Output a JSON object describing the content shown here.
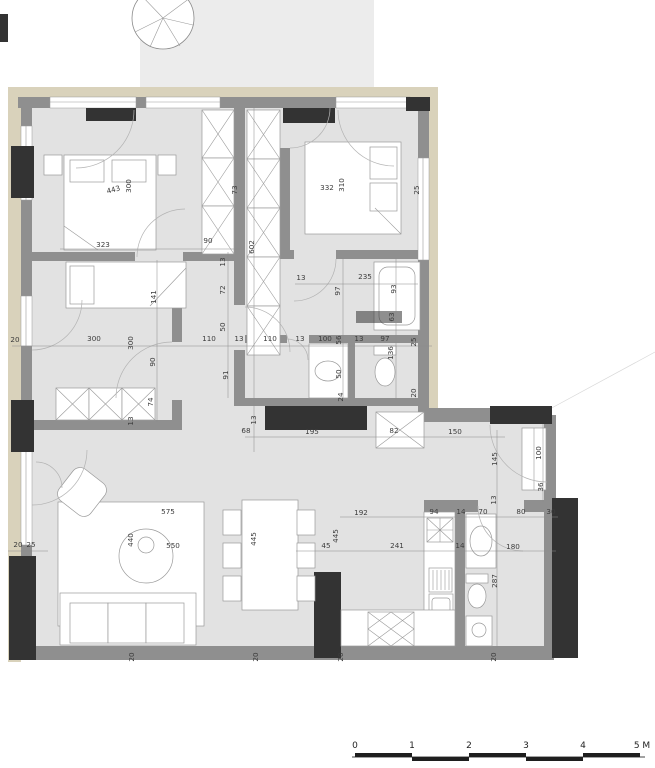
{
  "colors": {
    "paper": "#ffffff",
    "floor": "#e2e2e2",
    "terrace": "#ececec",
    "facade": "#d9d2bb",
    "wall": "#8f8f8f",
    "dark": "#333333"
  },
  "scale_bar": {
    "ticks": [
      {
        "label": "0",
        "x": 355
      },
      {
        "label": "1",
        "x": 412
      },
      {
        "label": "2",
        "x": 469
      },
      {
        "label": "3",
        "x": 526
      },
      {
        "label": "4",
        "x": 583
      },
      {
        "label": "5 M",
        "x": 642
      }
    ]
  },
  "plan_labels": [
    {
      "text": "443",
      "x": 114,
      "y": 192,
      "rot": -15
    },
    {
      "text": "300",
      "x": 131,
      "y": 186,
      "rot": -90
    },
    {
      "text": "323",
      "x": 103,
      "y": 247,
      "rot": 0
    },
    {
      "text": "90",
      "x": 208,
      "y": 243,
      "rot": 0
    },
    {
      "text": "73",
      "x": 237,
      "y": 190,
      "rot": -90
    },
    {
      "text": "13",
      "x": 225,
      "y": 262,
      "rot": -90
    },
    {
      "text": "602",
      "x": 254,
      "y": 247,
      "rot": -90
    },
    {
      "text": "72",
      "x": 225,
      "y": 290,
      "rot": -90
    },
    {
      "text": "50",
      "x": 225,
      "y": 327,
      "rot": -90
    },
    {
      "text": "332",
      "x": 327,
      "y": 190,
      "rot": 0
    },
    {
      "text": "310",
      "x": 344,
      "y": 185,
      "rot": -90
    },
    {
      "text": "25",
      "x": 419,
      "y": 190,
      "rot": -90
    },
    {
      "text": "13",
      "x": 301,
      "y": 280,
      "rot": 0
    },
    {
      "text": "235",
      "x": 365,
      "y": 279,
      "rot": 0
    },
    {
      "text": "97",
      "x": 340,
      "y": 291,
      "rot": -90
    },
    {
      "text": "93",
      "x": 396,
      "y": 289,
      "rot": -90
    },
    {
      "text": "63",
      "x": 394,
      "y": 317,
      "rot": -90
    },
    {
      "text": "25",
      "x": 416,
      "y": 342,
      "rot": -90
    },
    {
      "text": "20",
      "x": 416,
      "y": 393,
      "rot": -90
    },
    {
      "text": "20",
      "x": 15,
      "y": 342,
      "rot": 0
    },
    {
      "text": "300",
      "x": 94,
      "y": 341,
      "rot": 0
    },
    {
      "text": "300",
      "x": 133,
      "y": 343,
      "rot": -90
    },
    {
      "text": "110",
      "x": 209,
      "y": 341,
      "rot": 0
    },
    {
      "text": "13",
      "x": 239,
      "y": 341,
      "rot": 0
    },
    {
      "text": "110",
      "x": 270,
      "y": 341,
      "rot": 0
    },
    {
      "text": "13",
      "x": 300,
      "y": 341,
      "rot": 0
    },
    {
      "text": "100",
      "x": 325,
      "y": 341,
      "rot": 0
    },
    {
      "text": "56",
      "x": 341,
      "y": 340,
      "rot": -90
    },
    {
      "text": "13",
      "x": 359,
      "y": 341,
      "rot": 0
    },
    {
      "text": "97",
      "x": 385,
      "y": 341,
      "rot": 0
    },
    {
      "text": "141",
      "x": 156,
      "y": 297,
      "rot": -90
    },
    {
      "text": "90",
      "x": 155,
      "y": 362,
      "rot": -90
    },
    {
      "text": "74",
      "x": 153,
      "y": 402,
      "rot": -90
    },
    {
      "text": "13",
      "x": 133,
      "y": 421,
      "rot": -90
    },
    {
      "text": "91",
      "x": 228,
      "y": 375,
      "rot": -90
    },
    {
      "text": "50",
      "x": 341,
      "y": 374,
      "rot": -90
    },
    {
      "text": "136",
      "x": 393,
      "y": 353,
      "rot": -90
    },
    {
      "text": "24",
      "x": 343,
      "y": 397,
      "rot": -90
    },
    {
      "text": "68",
      "x": 246,
      "y": 433,
      "rot": 0
    },
    {
      "text": "13",
      "x": 256,
      "y": 420,
      "rot": -90
    },
    {
      "text": "195",
      "x": 312,
      "y": 434,
      "rot": 0
    },
    {
      "text": "82",
      "x": 394,
      "y": 433,
      "rot": 0
    },
    {
      "text": "150",
      "x": 455,
      "y": 434,
      "rot": 0
    },
    {
      "text": "145",
      "x": 497,
      "y": 459,
      "rot": -90
    },
    {
      "text": "100",
      "x": 541,
      "y": 453,
      "rot": -90
    },
    {
      "text": "36",
      "x": 543,
      "y": 487,
      "rot": -90
    },
    {
      "text": "13",
      "x": 496,
      "y": 500,
      "rot": -90
    },
    {
      "text": "94",
      "x": 434,
      "y": 514,
      "rot": 0
    },
    {
      "text": "14",
      "x": 461,
      "y": 514,
      "rot": 0
    },
    {
      "text": "70",
      "x": 483,
      "y": 514,
      "rot": 0
    },
    {
      "text": "80",
      "x": 521,
      "y": 514,
      "rot": 0
    },
    {
      "text": "30",
      "x": 551,
      "y": 514,
      "rot": 0
    },
    {
      "text": "180",
      "x": 513,
      "y": 549,
      "rot": 0
    },
    {
      "text": "14",
      "x": 460,
      "y": 548,
      "rot": 0
    },
    {
      "text": "287",
      "x": 497,
      "y": 581,
      "rot": -90
    },
    {
      "text": "575",
      "x": 168,
      "y": 514,
      "rot": 0
    },
    {
      "text": "440",
      "x": 133,
      "y": 540,
      "rot": -90
    },
    {
      "text": "550",
      "x": 173,
      "y": 548,
      "rot": 0
    },
    {
      "text": "445",
      "x": 256,
      "y": 539,
      "rot": -90
    },
    {
      "text": "45",
      "x": 326,
      "y": 548,
      "rot": 0
    },
    {
      "text": "445",
      "x": 338,
      "y": 536,
      "rot": -90
    },
    {
      "text": "192",
      "x": 361,
      "y": 515,
      "rot": 0
    },
    {
      "text": "241",
      "x": 397,
      "y": 548,
      "rot": 0
    },
    {
      "text": "20",
      "x": 18,
      "y": 547,
      "rot": 0
    },
    {
      "text": "25",
      "x": 31,
      "y": 547,
      "rot": 0
    },
    {
      "text": "20",
      "x": 134,
      "y": 657,
      "rot": -90
    },
    {
      "text": "20",
      "x": 258,
      "y": 657,
      "rot": -90
    },
    {
      "text": "20",
      "x": 343,
      "y": 657,
      "rot": -90
    },
    {
      "text": "20",
      "x": 496,
      "y": 657,
      "rot": -90
    }
  ]
}
